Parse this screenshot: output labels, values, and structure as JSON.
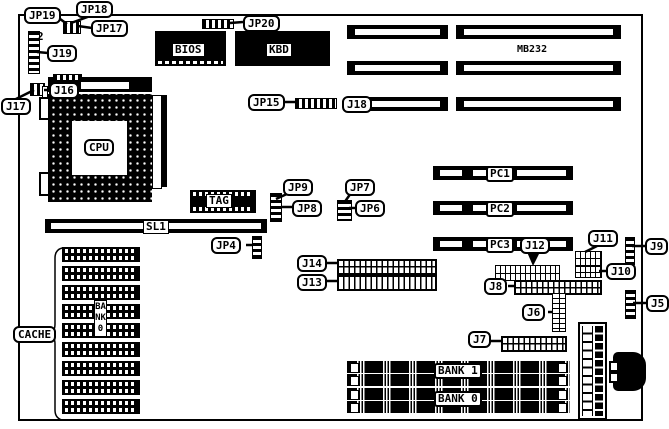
{
  "diagram": {
    "type": "motherboard-layout-diagram",
    "colors": {
      "foreground": "#000000",
      "background": "#ffffff"
    },
    "labels": {
      "jp19": "JP19",
      "jp18": "JP18",
      "jp17": "JP17",
      "j19": "J19",
      "pin2": "2",
      "j17": "J17",
      "j16": "J16",
      "jp20": "JP20",
      "bios": "BIOS",
      "kbd": "KBD",
      "mb232": "MB232",
      "jp15": "JP15",
      "j18": "J18",
      "cpu": "CPU",
      "tag": "TAG",
      "sl1": "SL1",
      "jp9": "JP9",
      "jp8": "JP8",
      "jp7": "JP7",
      "jp6": "JP6",
      "jp4": "JP4",
      "j14": "J14",
      "j13": "J13",
      "pc1": "PC1",
      "pc2": "PC2",
      "pc3": "PC3",
      "j12": "J12",
      "j11": "J11",
      "j10": "J10",
      "j9": "J9",
      "j8": "J8",
      "j6": "J6",
      "j5": "J5",
      "j7": "J7",
      "cache": "CACHE",
      "bank0_vertical": "BANK0",
      "bank1": "BANK 1",
      "bank0": "BANK 0"
    }
  }
}
